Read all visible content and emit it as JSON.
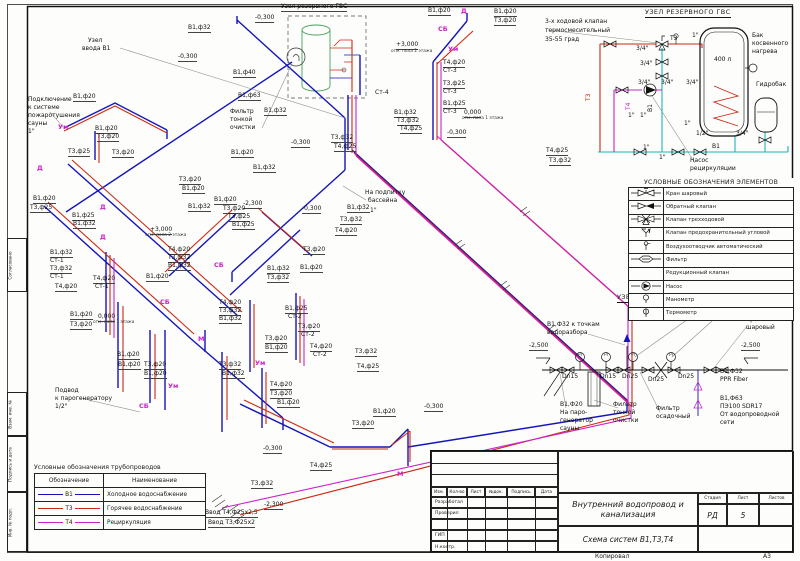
{
  "sheet": {
    "format": "А3",
    "footer_copy": "Копировал"
  },
  "colors": {
    "v1": "#1515bb",
    "t3": "#cc2a12",
    "t4": "#cc22cc",
    "cy": "#19b8b8",
    "tank": "#44a05c"
  },
  "side_stamp": {
    "items": [
      "Согласовано",
      "Взам. инв. №",
      "Подпись и дата",
      "Инв. № подл."
    ]
  },
  "reserve_unit": {
    "title": "УЗЕЛ РЕЗЕРВНОГО ГВС",
    "labels": [
      {
        "t": "3-х ходовой клапан",
        "x": 545,
        "y": 19,
        "c": "t"
      },
      {
        "t": "термосмесительный",
        "x": 545,
        "y": 28,
        "c": "t"
      },
      {
        "t": "35-55 град",
        "x": 545,
        "y": 37,
        "c": "t"
      },
      {
        "t": "Т3",
        "x": 592,
        "y": 95,
        "c": "r",
        "rot": 1
      },
      {
        "t": "Т4",
        "x": 632,
        "y": 104,
        "c": "p",
        "rot": 1
      },
      {
        "t": "В1",
        "x": 654,
        "y": 106,
        "c": "t",
        "rot": 1
      },
      {
        "t": "Т3",
        "x": 670,
        "y": 36,
        "c": "t"
      },
      {
        "t": "1\"",
        "x": 692,
        "y": 33,
        "c": "t"
      },
      {
        "t": "3/4\"",
        "x": 636,
        "y": 46,
        "c": "t"
      },
      {
        "t": "3/4\"",
        "x": 640,
        "y": 61,
        "c": "t"
      },
      {
        "t": "3/4\"",
        "x": 638,
        "y": 80,
        "c": "t"
      },
      {
        "t": "3/4\"",
        "x": 661,
        "y": 80,
        "c": "t"
      },
      {
        "t": "3/4\"",
        "x": 686,
        "y": 80,
        "c": "t"
      },
      {
        "t": "Бак",
        "x": 752,
        "y": 33,
        "c": "t"
      },
      {
        "t": "косвенного",
        "x": 752,
        "y": 41,
        "c": "t"
      },
      {
        "t": "нагрева",
        "x": 752,
        "y": 49,
        "c": "t"
      },
      {
        "t": "400 л",
        "x": 714,
        "y": 57,
        "c": "t"
      },
      {
        "t": "Гидробак",
        "x": 756,
        "y": 82,
        "c": "t"
      },
      {
        "t": "1\"",
        "x": 628,
        "y": 113,
        "c": "t"
      },
      {
        "t": "1\"",
        "x": 640,
        "y": 113,
        "c": "t"
      },
      {
        "t": "1\"",
        "x": 684,
        "y": 121,
        "c": "t"
      },
      {
        "t": "1/2\"",
        "x": 696,
        "y": 131,
        "c": "t"
      },
      {
        "t": "3/4\"",
        "x": 736,
        "y": 131,
        "c": "t"
      },
      {
        "t": "1\"",
        "x": 643,
        "y": 145,
        "c": "t"
      },
      {
        "t": "1\"",
        "x": 659,
        "y": 155,
        "c": "t"
      },
      {
        "t": "В1",
        "x": 712,
        "y": 144,
        "c": "t"
      },
      {
        "t": "Насос",
        "x": 690,
        "y": 158,
        "c": "t"
      },
      {
        "t": "рециркуляции",
        "x": 690,
        "y": 166,
        "c": "t"
      }
    ]
  },
  "elements_legend": {
    "title": "УСЛОВНЫЕ ОБОЗНАЧЕНИЯ ЭЛЕМЕНТОВ",
    "items": [
      {
        "icon": "ball-valve",
        "label": "Кран шаровый"
      },
      {
        "icon": "check-valve",
        "label": "Обратный клапан"
      },
      {
        "icon": "three-way-valve",
        "label": "Клапан трехходовой"
      },
      {
        "icon": "safety-angle-valve",
        "label": "Клапан предохранительный угловой"
      },
      {
        "icon": "air-vent",
        "label": "Воздухоотводчик автоматический"
      },
      {
        "icon": "filter",
        "label": "Фильтр"
      },
      {
        "icon": "none",
        "label": "Редукционный клапан"
      },
      {
        "icon": "pump",
        "label": "Насос"
      },
      {
        "icon": "manometer",
        "label": "Манометр"
      },
      {
        "icon": "thermometer",
        "label": "Термометр"
      }
    ]
  },
  "inlet_unit": {
    "title": "УЗЕЛ ВВОДА В1",
    "labels": [
      {
        "t": "Манометр",
        "x": 695,
        "y": 302,
        "c": "t"
      },
      {
        "t": "Кран",
        "x": 746,
        "y": 317,
        "c": "t"
      },
      {
        "t": "шаровый",
        "x": 746,
        "y": 325,
        "c": "t"
      },
      {
        "t": "В1,Ф32 к точкам",
        "x": 547,
        "y": 322,
        "c": "t"
      },
      {
        "t": "водоразбора",
        "x": 547,
        "y": 330,
        "c": "t"
      },
      {
        "t": "-2,500",
        "x": 529,
        "y": 343
      },
      {
        "t": "-2,500",
        "x": 741,
        "y": 343
      },
      {
        "t": "PI",
        "x": 578,
        "y": 354,
        "c": "s"
      },
      {
        "t": "PI",
        "x": 604,
        "y": 354,
        "c": "s"
      },
      {
        "t": "PI",
        "x": 631,
        "y": 354,
        "c": "s"
      },
      {
        "t": "PI",
        "x": 669,
        "y": 354,
        "c": "s"
      },
      {
        "t": "Dn15",
        "x": 562,
        "y": 374,
        "c": "t"
      },
      {
        "t": "Dn15",
        "x": 600,
        "y": 374,
        "c": "t"
      },
      {
        "t": "Dn25",
        "x": 622,
        "y": 374,
        "c": "t"
      },
      {
        "t": "Dn25",
        "x": 648,
        "y": 377,
        "c": "t"
      },
      {
        "t": "Dn25",
        "x": 678,
        "y": 374,
        "c": "t"
      },
      {
        "t": "В1,Ф32",
        "x": 720,
        "y": 369,
        "c": "t"
      },
      {
        "t": "PPR Fiber",
        "x": 720,
        "y": 377,
        "c": "t"
      },
      {
        "t": "В1,Ф63",
        "x": 720,
        "y": 396,
        "c": "t"
      },
      {
        "t": "ПЭ100 SDR17",
        "x": 720,
        "y": 404,
        "c": "t"
      },
      {
        "t": "От водопроводной",
        "x": 720,
        "y": 412,
        "c": "t"
      },
      {
        "t": "сети",
        "x": 720,
        "y": 420,
        "c": "t"
      },
      {
        "t": "В1,Ф20",
        "x": 560,
        "y": 402,
        "c": "t"
      },
      {
        "t": "На паро-",
        "x": 560,
        "y": 410,
        "c": "t"
      },
      {
        "t": "генератор",
        "x": 560,
        "y": 418,
        "c": "t"
      },
      {
        "t": "сауны",
        "x": 560,
        "y": 426,
        "c": "t"
      },
      {
        "t": "Фильтр",
        "x": 613,
        "y": 402,
        "c": "t"
      },
      {
        "t": "тонкой",
        "x": 613,
        "y": 410,
        "c": "t"
      },
      {
        "t": "очистки",
        "x": 613,
        "y": 418,
        "c": "t"
      },
      {
        "t": "Фильтр",
        "x": 656,
        "y": 406,
        "c": "t"
      },
      {
        "t": "осадочный",
        "x": 656,
        "y": 414,
        "c": "t"
      }
    ]
  },
  "pipes_legend": {
    "title": "Условные обозначения трубопроводов",
    "col1": "Обозначение",
    "col2": "Наименование",
    "rows": [
      {
        "code": "В1",
        "name": "Холодное водоснабжение",
        "color_hex": "#1515bb"
      },
      {
        "code": "Т3",
        "name": "Горячее водоснабжение",
        "color_hex": "#cc2a12"
      },
      {
        "code": "Т4",
        "name": "Рециркуляция",
        "color_hex": "#cc22cc"
      }
    ]
  },
  "title_block": {
    "doc_title_1": "Внутренний водопровод и",
    "doc_title_2": "канализация",
    "scheme_title": "Схема систем В1,Т3,Т4",
    "stage_label": "Стадия",
    "sheet_label": "Лист",
    "sheets_label": "Листов",
    "stage": "РД",
    "sheet_no": "5",
    "cols": [
      "Изм.",
      "Кол-во",
      "Лист",
      "№док.",
      "Подпись",
      "Дата"
    ],
    "roles": [
      "Разработал",
      "Проверил",
      "",
      "ГИП",
      "Н.контр."
    ],
    "footer_copy": "Копировал",
    "format": "А3"
  },
  "diagram": {
    "labels": [
      {
        "t": "Узел резервного ГВС",
        "x": 281,
        "y": 4
      },
      {
        "t": "-0,300",
        "x": 255,
        "y": 15
      },
      {
        "t": "-0,300",
        "x": 178,
        "y": 54
      },
      {
        "t": "В1,ф32",
        "x": 188,
        "y": 25
      },
      {
        "t": "Узел",
        "x": 88,
        "y": 38,
        "c": "t"
      },
      {
        "t": "ввода В1",
        "x": 82,
        "y": 46,
        "c": "t"
      },
      {
        "t": "В1,ф20",
        "x": 73,
        "y": 94
      },
      {
        "t": "Подключение",
        "x": 28,
        "y": 97,
        "c": "t"
      },
      {
        "t": "к системе",
        "x": 28,
        "y": 105,
        "c": "t"
      },
      {
        "t": "пожаротушения",
        "x": 28,
        "y": 113,
        "c": "t"
      },
      {
        "t": "сауны",
        "x": 28,
        "y": 121,
        "c": "t"
      },
      {
        "t": "1\"",
        "x": 28,
        "y": 129,
        "c": "t"
      },
      {
        "t": "Ум",
        "x": 58,
        "y": 124,
        "c": "m"
      },
      {
        "t": "В1,ф20",
        "x": 95,
        "y": 126
      },
      {
        "t": "Т3,ф20",
        "x": 97,
        "y": 134
      },
      {
        "t": "Т3,ф25",
        "x": 68,
        "y": 149
      },
      {
        "t": "Т3,ф20",
        "x": 112,
        "y": 150
      },
      {
        "t": "В1,ф40",
        "x": 233,
        "y": 70
      },
      {
        "t": "В1,ф63",
        "x": 238,
        "y": 93
      },
      {
        "t": "Фильтр",
        "x": 230,
        "y": 109,
        "c": "t"
      },
      {
        "t": "тонкой",
        "x": 230,
        "y": 117,
        "c": "t"
      },
      {
        "t": "очистки",
        "x": 230,
        "y": 125,
        "c": "t"
      },
      {
        "t": "В1,ф32",
        "x": 264,
        "y": 108
      },
      {
        "t": "Ст-4",
        "x": 375,
        "y": 90,
        "c": "t"
      },
      {
        "t": "В1,ф32",
        "x": 394,
        "y": 110
      },
      {
        "t": "Т3,ф32",
        "x": 397,
        "y": 118
      },
      {
        "t": "Т4,ф25",
        "x": 400,
        "y": 126
      },
      {
        "t": "+3,000",
        "x": 396,
        "y": 42
      },
      {
        "t": "отм. пола 2 этажа",
        "x": 391,
        "y": 50,
        "c": "s"
      },
      {
        "t": "В1,ф20",
        "x": 428,
        "y": 8
      },
      {
        "t": "Д",
        "x": 461,
        "y": 8,
        "c": "m"
      },
      {
        "t": "В1,ф20",
        "x": 494,
        "y": 9
      },
      {
        "t": "Т3,ф20",
        "x": 494,
        "y": 18
      },
      {
        "t": "СБ",
        "x": 438,
        "y": 26,
        "c": "m"
      },
      {
        "t": "Ум",
        "x": 448,
        "y": 46,
        "c": "m"
      },
      {
        "t": "Т4,ф20",
        "x": 443,
        "y": 60
      },
      {
        "t": "Ст-3",
        "x": 443,
        "y": 68,
        "c": "t"
      },
      {
        "t": "Т3,ф25",
        "x": 443,
        "y": 81
      },
      {
        "t": "Ст-3",
        "x": 443,
        "y": 89,
        "c": "t"
      },
      {
        "t": "В1,ф25",
        "x": 443,
        "y": 101
      },
      {
        "t": "Ст-3",
        "x": 443,
        "y": 109,
        "c": "t"
      },
      {
        "t": "0,000",
        "x": 464,
        "y": 110
      },
      {
        "t": "отм. пола 1 этажа",
        "x": 462,
        "y": 117,
        "c": "s"
      },
      {
        "t": "-0,300",
        "x": 447,
        "y": 130
      },
      {
        "t": "Т4,ф25",
        "x": 546,
        "y": 148
      },
      {
        "t": "Т3,ф32",
        "x": 549,
        "y": 158
      },
      {
        "t": "На подпитку",
        "x": 365,
        "y": 190,
        "c": "t"
      },
      {
        "t": "бассейна",
        "x": 368,
        "y": 198,
        "c": "t"
      },
      {
        "t": "В1,ф32",
        "x": 347,
        "y": 205
      },
      {
        "t": "1\"",
        "x": 370,
        "y": 208,
        "c": "t"
      },
      {
        "t": "Т3,ф32",
        "x": 340,
        "y": 217
      },
      {
        "t": "Т4,ф20",
        "x": 335,
        "y": 228
      },
      {
        "t": "-2,300",
        "x": 243,
        "y": 201
      },
      {
        "t": "-0,300",
        "x": 302,
        "y": 206
      },
      {
        "t": "-0,300",
        "x": 291,
        "y": 140
      },
      {
        "t": "В1,ф20",
        "x": 231,
        "y": 150
      },
      {
        "t": "В1,ф32",
        "x": 253,
        "y": 165
      },
      {
        "t": "Т3,ф32",
        "x": 331,
        "y": 135
      },
      {
        "t": "Т4,ф25",
        "x": 334,
        "y": 144
      },
      {
        "t": "Т3,ф20",
        "x": 179,
        "y": 177
      },
      {
        "t": "В1,ф20",
        "x": 182,
        "y": 186
      },
      {
        "t": "В1,ф20",
        "x": 214,
        "y": 197
      },
      {
        "t": "В1,ф32",
        "x": 188,
        "y": 204
      },
      {
        "t": "Т3,ф20",
        "x": 223,
        "y": 206
      },
      {
        "t": "Т3,ф25",
        "x": 228,
        "y": 214
      },
      {
        "t": "В1,ф25",
        "x": 232,
        "y": 222
      },
      {
        "t": "Т4,ф20",
        "x": 168,
        "y": 247
      },
      {
        "t": "Т3,ф32",
        "x": 168,
        "y": 255
      },
      {
        "t": "В1,ф32",
        "x": 168,
        "y": 263
      },
      {
        "t": "СБ",
        "x": 214,
        "y": 262,
        "c": "m"
      },
      {
        "t": "Т3,ф20",
        "x": 303,
        "y": 247
      },
      {
        "t": "В1,ф32",
        "x": 267,
        "y": 266
      },
      {
        "t": "Т3,ф32",
        "x": 267,
        "y": 275
      },
      {
        "t": "В1,ф20",
        "x": 300,
        "y": 265
      },
      {
        "t": "Т4,ф20",
        "x": 219,
        "y": 300
      },
      {
        "t": "Т3,ф32",
        "x": 219,
        "y": 308
      },
      {
        "t": "В1,ф32",
        "x": 219,
        "y": 316
      },
      {
        "t": "В1,ф25",
        "x": 285,
        "y": 306
      },
      {
        "t": "Ст-2",
        "x": 288,
        "y": 314,
        "c": "t"
      },
      {
        "t": "Т3,ф20",
        "x": 298,
        "y": 324
      },
      {
        "t": "Ст-2",
        "x": 301,
        "y": 332,
        "c": "t"
      },
      {
        "t": "Т4,ф20",
        "x": 310,
        "y": 344
      },
      {
        "t": "Ст-2",
        "x": 313,
        "y": 352,
        "c": "t"
      },
      {
        "t": "Т3,ф20",
        "x": 265,
        "y": 336
      },
      {
        "t": "В1,ф20",
        "x": 265,
        "y": 345
      },
      {
        "t": "Ум",
        "x": 255,
        "y": 360,
        "c": "m"
      },
      {
        "t": "СБ",
        "x": 160,
        "y": 299,
        "c": "m"
      },
      {
        "t": "Т3,ф32",
        "x": 355,
        "y": 349
      },
      {
        "t": "Т4,ф25",
        "x": 357,
        "y": 364
      },
      {
        "t": "Т3,ф32",
        "x": 219,
        "y": 362
      },
      {
        "t": "В1,ф32",
        "x": 222,
        "y": 371
      },
      {
        "t": "Т4,ф20",
        "x": 270,
        "y": 382
      },
      {
        "t": "Т3,ф20",
        "x": 270,
        "y": 391
      },
      {
        "t": "В1,ф20",
        "x": 277,
        "y": 400
      },
      {
        "t": "В1,ф32",
        "x": 50,
        "y": 250
      },
      {
        "t": "Ст-1",
        "x": 50,
        "y": 258,
        "c": "t"
      },
      {
        "t": "Т3,ф32",
        "x": 50,
        "y": 266
      },
      {
        "t": "Ст-1",
        "x": 50,
        "y": 274,
        "c": "t"
      },
      {
        "t": "Т4,ф20",
        "x": 93,
        "y": 276
      },
      {
        "t": "Ст-1",
        "x": 95,
        "y": 284,
        "c": "t"
      },
      {
        "t": "Т4,ф20",
        "x": 55,
        "y": 284
      },
      {
        "t": "Д",
        "x": 37,
        "y": 165,
        "c": "m"
      },
      {
        "t": "Д",
        "x": 100,
        "y": 204,
        "c": "m"
      },
      {
        "t": "Д",
        "x": 100,
        "y": 234,
        "c": "m"
      },
      {
        "t": "В1,ф20",
        "x": 33,
        "y": 196
      },
      {
        "t": "Т3,ф25",
        "x": 30,
        "y": 205
      },
      {
        "t": "В1,ф25",
        "x": 72,
        "y": 213
      },
      {
        "t": "В1,ф32",
        "x": 73,
        "y": 221
      },
      {
        "t": "+3,000",
        "x": 150,
        "y": 227
      },
      {
        "t": "отм. пола 2 этажа",
        "x": 145,
        "y": 234,
        "c": "s"
      },
      {
        "t": "В1,ф20",
        "x": 146,
        "y": 274
      },
      {
        "t": "В1,ф20",
        "x": 70,
        "y": 312
      },
      {
        "t": "Т3,ф20",
        "x": 70,
        "y": 322
      },
      {
        "t": "0,000",
        "x": 98,
        "y": 314
      },
      {
        "t": "отм. пола 1 этажа",
        "x": 93,
        "y": 321,
        "c": "s"
      },
      {
        "t": "М",
        "x": 198,
        "y": 336,
        "c": "m"
      },
      {
        "t": "В1,ф20",
        "x": 117,
        "y": 352
      },
      {
        "t": "В1,ф20",
        "x": 118,
        "y": 362
      },
      {
        "t": "Т3,ф20",
        "x": 144,
        "y": 362
      },
      {
        "t": "В1,ф20",
        "x": 144,
        "y": 371
      },
      {
        "t": "Ум",
        "x": 168,
        "y": 383,
        "c": "m"
      },
      {
        "t": "СБ",
        "x": 139,
        "y": 403,
        "c": "m"
      },
      {
        "t": "Подвод",
        "x": 55,
        "y": 388,
        "c": "t"
      },
      {
        "t": "к парогенератору",
        "x": 55,
        "y": 396,
        "c": "t"
      },
      {
        "t": "1/2\"",
        "x": 55,
        "y": 404,
        "c": "t"
      },
      {
        "t": "Т3,ф20",
        "x": 352,
        "y": 421
      },
      {
        "t": "В1,ф20",
        "x": 373,
        "y": 409
      },
      {
        "t": "-0,300",
        "x": 424,
        "y": 404
      },
      {
        "t": "М",
        "x": 397,
        "y": 471,
        "c": "m"
      },
      {
        "t": "-0,300",
        "x": 263,
        "y": 446
      },
      {
        "t": "Т4,ф25",
        "x": 310,
        "y": 463
      },
      {
        "t": "Т3,ф32",
        "x": 251,
        "y": 481
      },
      {
        "t": "-2,300",
        "x": 264,
        "y": 502
      },
      {
        "t": "Ввод Т4,Ф25х2,5",
        "x": 205,
        "y": 510
      },
      {
        "t": "Ввод Т3,Ф25х2",
        "x": 208,
        "y": 520
      }
    ]
  }
}
